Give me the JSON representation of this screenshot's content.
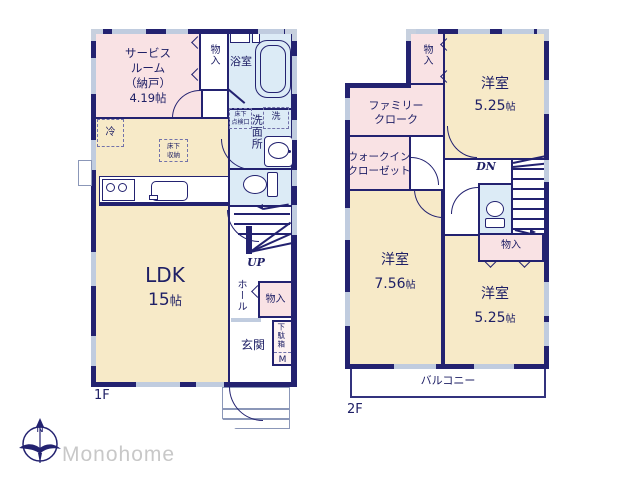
{
  "brand": {
    "name": "Monohome",
    "compass_n": "N"
  },
  "colors": {
    "wall": "#232270",
    "room_cream": "#f7eac8",
    "room_pink": "#f9e2e4",
    "room_wet_blue": "#dcebf6",
    "window_gray": "#c0ccdf",
    "logo_text_gray": "#c8c8c8"
  },
  "floor1": {
    "label": "1F",
    "rooms": {
      "service": "サービス\nルーム\n（納戸）\n4.19帖",
      "closet_top": "物入",
      "bath": "浴室",
      "washer": "洗",
      "hatch": "床下\n点検口",
      "washroom": "洗面所",
      "fridge": "冷",
      "floor_storage": "床下\n収納",
      "ldk": {
        "name": "LDK",
        "size_num": "15",
        "size_unit": "帖"
      },
      "up": "UP",
      "hall": "ホール",
      "closet": "物入",
      "entrance": "玄関",
      "shoebox": "下駄箱",
      "shoebox_m": "M"
    }
  },
  "floor2": {
    "label": "2F",
    "rooms": {
      "closet_top": "物入",
      "room_a": {
        "name": "洋室",
        "size_num": "5.25",
        "size_unit": "帖"
      },
      "family_cloak": "ファミリー\nクローク",
      "wic": "ウォークイン\nクローゼット",
      "dn": "DN",
      "closet_mid": "物入",
      "room_b": {
        "name": "洋室",
        "size_num": "7.56",
        "size_unit": "帖"
      },
      "room_c": {
        "name": "洋室",
        "size_num": "5.25",
        "size_unit": "帖"
      },
      "balcony": "バルコニー"
    }
  }
}
